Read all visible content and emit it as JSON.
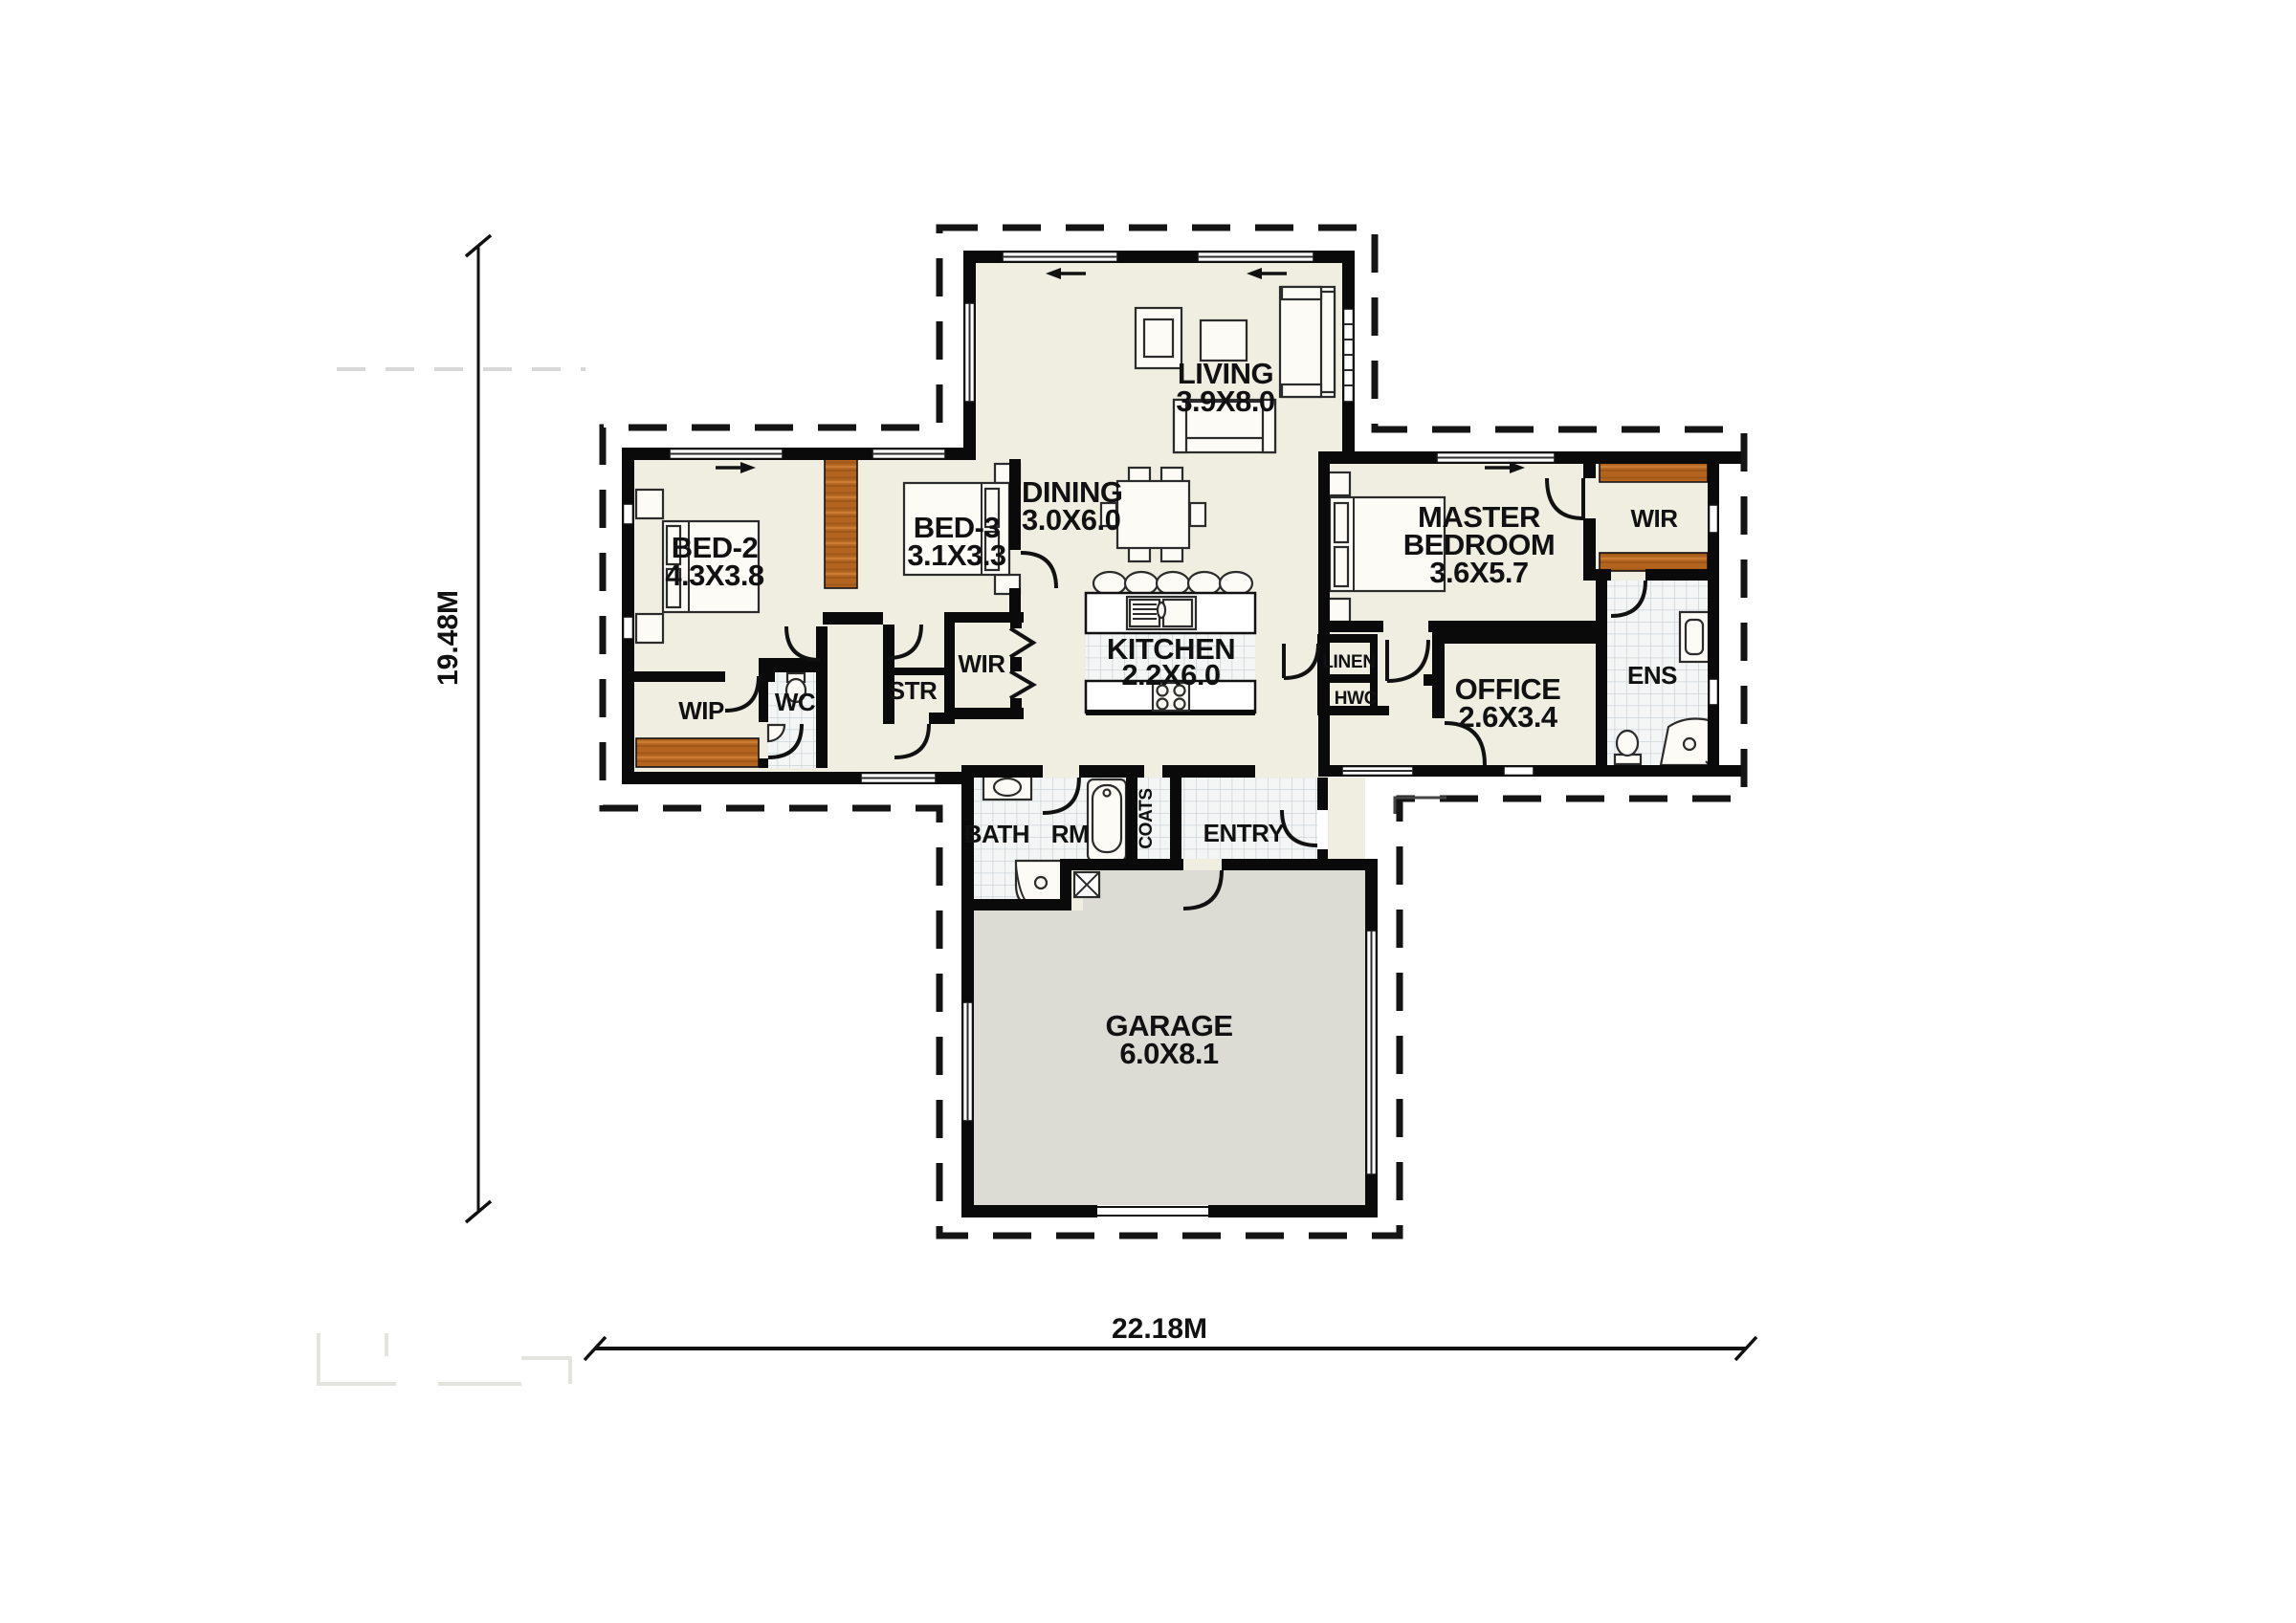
{
  "plan": {
    "rooms": {
      "living": {
        "name": "LIVING",
        "size": "3.9X8.0"
      },
      "dining": {
        "name": "DINING",
        "size": "3.0X6.0"
      },
      "kitchen": {
        "name": "KITCHEN",
        "size": "2.2X6.0"
      },
      "bed2": {
        "name": "BED-2",
        "size": "4.3X3.8"
      },
      "bed3": {
        "name": "BED-3",
        "size": "3.1X3.3"
      },
      "master": {
        "line1": "MASTER",
        "line2": "BEDROOM",
        "size": "3.6X5.7"
      },
      "office": {
        "name": "OFFICE",
        "size": "2.6X3.4"
      },
      "garage": {
        "name": "GARAGE",
        "size": "6.0X8.1"
      },
      "wip": {
        "name": "WIP"
      },
      "wc": {
        "name": "WC"
      },
      "str": {
        "name": "STR"
      },
      "wir_left": {
        "name": "WIR"
      },
      "wir_right": {
        "name": "WIR"
      },
      "linen": {
        "name": "LINEN"
      },
      "hwc": {
        "name": "HWC"
      },
      "ens": {
        "name": "ENS"
      },
      "bath": {
        "name": "BATH RM"
      },
      "coats": {
        "name": "COATS"
      },
      "entry": {
        "name": "ENTRY"
      }
    },
    "dimensions": {
      "height": "19.48M",
      "width": "22.18M"
    },
    "colors": {
      "floor": "#f0eee1",
      "garage_floor": "#dcdcd5",
      "wood": "#b2641f",
      "wall": "#0a0a0a",
      "tile_line": "#ccd5d9"
    }
  }
}
